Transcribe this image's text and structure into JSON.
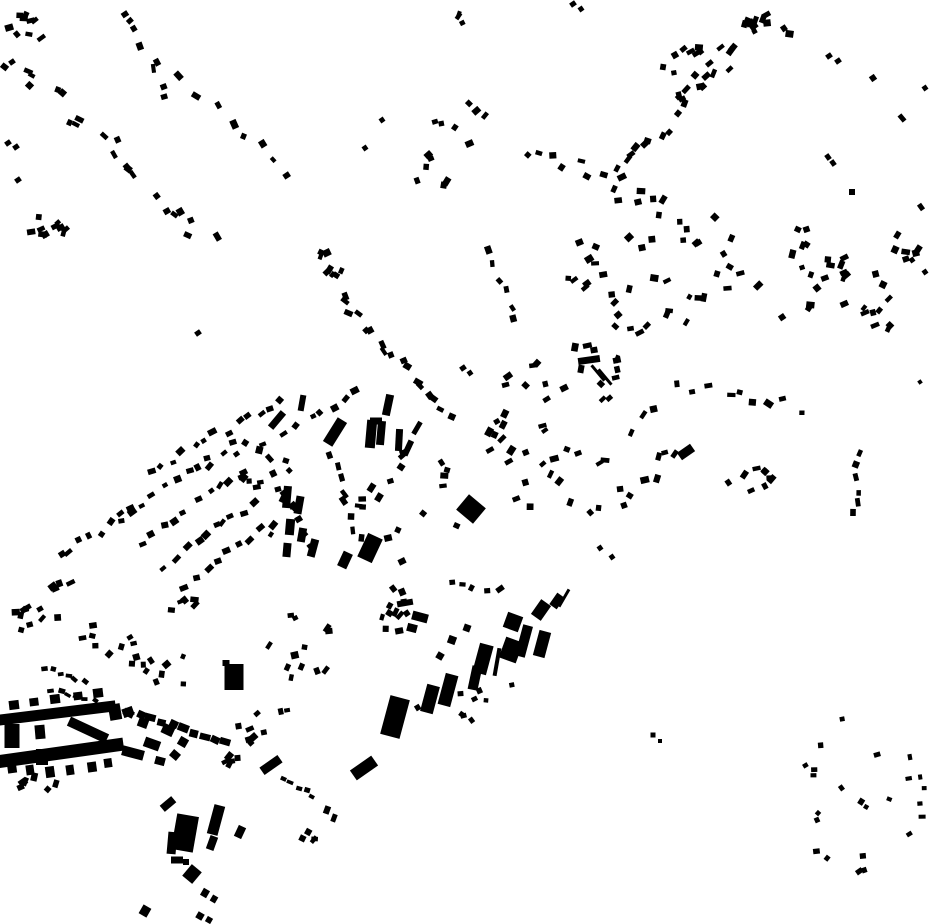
{
  "meta": {
    "title": "building-footprint-map",
    "width": 930,
    "height": 924,
    "background_color": "#ffffff",
    "building_color": "#000000"
  },
  "buildings": [
    [
      57,
      713,
      118,
      11,
      -7
    ],
    [
      60,
      753,
      128,
      13,
      -8
    ],
    [
      14,
      705,
      10,
      9,
      -7
    ],
    [
      34,
      702,
      9,
      8,
      -7
    ],
    [
      55,
      699,
      10,
      9,
      -7
    ],
    [
      78,
      696,
      9,
      8,
      -7
    ],
    [
      98,
      693,
      10,
      9,
      -7
    ],
    [
      12,
      736,
      15,
      24,
      0
    ],
    [
      40,
      732,
      10,
      14,
      -5
    ],
    [
      42,
      757,
      12,
      16,
      0
    ],
    [
      115,
      712,
      12,
      16,
      -10
    ],
    [
      88,
      730,
      42,
      10,
      25
    ],
    [
      12,
      768,
      9,
      10,
      -8
    ],
    [
      30,
      770,
      8,
      10,
      -8
    ],
    [
      50,
      772,
      9,
      11,
      -8
    ],
    [
      70,
      770,
      8,
      10,
      -8
    ],
    [
      92,
      767,
      9,
      10,
      -8
    ],
    [
      108,
      763,
      8,
      9,
      -8
    ],
    [
      133,
      753,
      22,
      10,
      15
    ],
    [
      152,
      744,
      16,
      10,
      20
    ],
    [
      168,
      730,
      12,
      10,
      25
    ],
    [
      143,
      723,
      10,
      9,
      20
    ],
    [
      128,
      712,
      11,
      9,
      -20
    ],
    [
      160,
      761,
      10,
      8,
      15
    ],
    [
      175,
      755,
      9,
      8,
      40
    ],
    [
      183,
      742,
      9,
      9,
      30
    ],
    [
      234,
      677,
      19,
      26,
      0
    ],
    [
      226,
      663,
      7,
      6,
      0
    ],
    [
      395,
      717,
      20,
      40,
      15
    ],
    [
      430,
      699,
      13,
      28,
      15
    ],
    [
      448,
      690,
      13,
      32,
      15
    ],
    [
      475,
      678,
      10,
      24,
      12
    ],
    [
      483,
      659,
      14,
      30,
      15
    ],
    [
      497,
      662,
      4,
      28,
      10
    ],
    [
      513,
      622,
      16,
      16,
      20
    ],
    [
      511,
      650,
      18,
      22,
      20
    ],
    [
      524,
      641,
      10,
      32,
      15
    ],
    [
      542,
      644,
      12,
      26,
      15
    ],
    [
      541,
      610,
      12,
      18,
      35
    ],
    [
      557,
      601,
      9,
      14,
      35
    ],
    [
      564,
      598,
      3,
      20,
      30
    ],
    [
      452,
      640,
      8,
      8,
      20
    ],
    [
      467,
      628,
      7,
      7,
      20
    ],
    [
      440,
      656,
      7,
      7,
      30
    ],
    [
      405,
      603,
      16,
      6,
      -10
    ],
    [
      420,
      617,
      16,
      9,
      15
    ],
    [
      412,
      628,
      10,
      8,
      15
    ],
    [
      185,
      833,
      22,
      36,
      10
    ],
    [
      172,
      843,
      9,
      22,
      5
    ],
    [
      177,
      860,
      12,
      7,
      0
    ],
    [
      168,
      804,
      15,
      8,
      -40
    ],
    [
      216,
      820,
      11,
      30,
      15
    ],
    [
      212,
      843,
      8,
      14,
      20
    ],
    [
      240,
      832,
      8,
      12,
      25
    ],
    [
      192,
      874,
      13,
      15,
      40
    ],
    [
      145,
      911,
      9,
      10,
      30
    ],
    [
      205,
      893,
      7,
      8,
      30
    ],
    [
      214,
      899,
      6,
      7,
      30
    ],
    [
      200,
      916,
      7,
      7,
      30
    ],
    [
      209,
      920,
      6,
      6,
      30
    ],
    [
      186,
      862,
      6,
      6,
      0
    ],
    [
      364,
      768,
      26,
      12,
      -35
    ],
    [
      271,
      765,
      22,
      9,
      -35
    ],
    [
      327,
      810,
      6,
      8,
      20
    ],
    [
      334,
      818,
      5,
      8,
      20
    ],
    [
      589,
      360,
      22,
      7,
      -8
    ],
    [
      594,
      350,
      7,
      6,
      -10
    ],
    [
      598,
      373,
      3,
      20,
      -40
    ],
    [
      605,
      377,
      3,
      20,
      -40
    ],
    [
      581,
      369,
      6,
      8,
      10
    ],
    [
      471,
      509,
      22,
      20,
      40
    ],
    [
      686,
      452,
      16,
      9,
      -35
    ],
    [
      388,
      405,
      8,
      21,
      12
    ],
    [
      335,
      432,
      11,
      28,
      32
    ],
    [
      371,
      434,
      10,
      28,
      5
    ],
    [
      381,
      433,
      8,
      24,
      5
    ],
    [
      376,
      421,
      12,
      7,
      0
    ],
    [
      399,
      440,
      7,
      22,
      3
    ],
    [
      408,
      448,
      6,
      16,
      25
    ],
    [
      417,
      428,
      5,
      14,
      30
    ],
    [
      277,
      420,
      7,
      20,
      40
    ],
    [
      302,
      403,
      6,
      16,
      10
    ],
    [
      287,
      497,
      8,
      22,
      5
    ],
    [
      299,
      505,
      8,
      18,
      10
    ],
    [
      290,
      527,
      9,
      16,
      5
    ],
    [
      302,
      535,
      8,
      14,
      10
    ],
    [
      287,
      550,
      8,
      14,
      5
    ],
    [
      313,
      548,
      8,
      18,
      15
    ],
    [
      370,
      548,
      16,
      26,
      25
    ],
    [
      345,
      560,
      10,
      16,
      25
    ],
    [
      653,
      735,
      5,
      5,
      0
    ],
    [
      660,
      741,
      4,
      4,
      0
    ],
    [
      12,
      62,
      6,
      5,
      -35
    ],
    [
      8,
      143,
      6,
      5,
      -35
    ],
    [
      16,
      147,
      6,
      5,
      -35
    ],
    [
      18,
      180,
      6,
      5,
      -35
    ],
    [
      198,
      333,
      6,
      5,
      -35
    ],
    [
      463,
      368,
      6,
      5,
      -35
    ],
    [
      470,
      373,
      5,
      5,
      -35
    ],
    [
      573,
      4,
      6,
      5,
      -35
    ],
    [
      581,
      9,
      5,
      5,
      -35
    ],
    [
      829,
      56,
      6,
      5,
      -35
    ],
    [
      838,
      61,
      6,
      5,
      -35
    ],
    [
      873,
      78,
      6,
      6,
      -35
    ],
    [
      902,
      118,
      5,
      8,
      -40
    ],
    [
      925,
      88,
      5,
      5,
      -35
    ],
    [
      828,
      157,
      5,
      6,
      -35
    ],
    [
      833,
      163,
      5,
      6,
      -35
    ],
    [
      852,
      192,
      6,
      6,
      0
    ],
    [
      921,
      207,
      5,
      7,
      -35
    ],
    [
      912,
      260,
      5,
      5,
      -35
    ],
    [
      925,
      272,
      5,
      5,
      -35
    ],
    [
      920,
      382,
      4,
      4,
      -35
    ],
    [
      600,
      548,
      5,
      5,
      -35
    ],
    [
      612,
      557,
      5,
      5,
      -35
    ],
    [
      28,
      607,
      6,
      5,
      -30
    ],
    [
      40,
      609,
      6,
      5,
      -30
    ],
    [
      382,
      120,
      5,
      5,
      -35
    ],
    [
      365,
      148,
      5,
      5,
      -35
    ]
  ],
  "clusters": [
    {
      "type": "chain",
      "seed": 101,
      "count": 22,
      "from": [
        14,
        60
      ],
      "to": [
        208,
        247
      ],
      "jitter": 13
    },
    {
      "type": "blob",
      "seed": 102,
      "count": 9,
      "center": [
        30,
        30
      ],
      "radius": [
        22,
        18
      ]
    },
    {
      "type": "chain",
      "seed": 103,
      "count": 8,
      "from": [
        128,
        8
      ],
      "to": [
        170,
        100
      ],
      "jitter": 7
    },
    {
      "type": "blob",
      "seed": 104,
      "count": 10,
      "center": [
        42,
        230
      ],
      "radius": [
        24,
        13
      ]
    },
    {
      "type": "chain",
      "seed": 105,
      "count": 8,
      "from": [
        183,
        78
      ],
      "to": [
        290,
        175
      ],
      "jitter": 6
    },
    {
      "type": "blob",
      "seed": 106,
      "count": 8,
      "center": [
        333,
        262
      ],
      "radius": [
        15,
        17
      ]
    },
    {
      "type": "chain",
      "seed": 107,
      "count": 17,
      "from": [
        340,
        298
      ],
      "to": [
        452,
        412
      ],
      "jitter": 6
    },
    {
      "type": "chain",
      "seed": 108,
      "count": 6,
      "from": [
        489,
        251
      ],
      "to": [
        514,
        318
      ],
      "jitter": 4
    },
    {
      "type": "blob",
      "seed": 109,
      "count": 7,
      "center": [
        462,
        124
      ],
      "radius": [
        28,
        22
      ]
    },
    {
      "type": "blob",
      "seed": 110,
      "count": 6,
      "center": [
        432,
        170
      ],
      "radius": [
        24,
        18
      ]
    },
    {
      "type": "chain",
      "seed": 111,
      "count": 7,
      "from": [
        520,
        150
      ],
      "to": [
        608,
        177
      ],
      "jitter": 8
    },
    {
      "type": "chain",
      "seed": 112,
      "count": 26,
      "from": [
        612,
        186
      ],
      "to": [
        764,
        12
      ],
      "jitter": 9
    },
    {
      "type": "blob",
      "seed": 113,
      "count": 12,
      "center": [
        688,
        72
      ],
      "radius": [
        26,
        28
      ]
    },
    {
      "type": "blob",
      "seed": 114,
      "count": 7,
      "center": [
        772,
        22
      ],
      "radius": [
        28,
        16
      ]
    },
    {
      "type": "blob",
      "seed": 115,
      "count": 46,
      "center": [
        650,
        262
      ],
      "radius": [
        92,
        72
      ]
    },
    {
      "type": "blob",
      "seed": 116,
      "count": 15,
      "center": [
        790,
        272
      ],
      "radius": [
        42,
        50
      ]
    },
    {
      "type": "blob",
      "seed": 117,
      "count": 22,
      "center": [
        882,
        282
      ],
      "radius": [
        46,
        52
      ]
    },
    {
      "type": "chain",
      "seed": 118,
      "count": 9,
      "from": [
        683,
        386
      ],
      "to": [
        795,
        408
      ],
      "jitter": 7
    },
    {
      "type": "blob",
      "seed": 119,
      "count": 9,
      "center": [
        752,
        482
      ],
      "radius": [
        27,
        15
      ]
    },
    {
      "type": "chain",
      "seed": 120,
      "count": 6,
      "from": [
        856,
        457
      ],
      "to": [
        855,
        512
      ],
      "jitter": 4
    },
    {
      "type": "blob",
      "seed": 121,
      "count": 54,
      "center": [
        575,
        432
      ],
      "radius": [
        105,
        92
      ]
    },
    {
      "type": "chain",
      "seed": 122,
      "count": 13,
      "from": [
        150,
        472
      ],
      "to": [
        280,
        399
      ],
      "jitter": 4
    },
    {
      "type": "chain",
      "seed": 123,
      "count": 11,
      "from": [
        118,
        516
      ],
      "to": [
        232,
        446
      ],
      "jitter": 4
    },
    {
      "type": "chain",
      "seed": 124,
      "count": 8,
      "from": [
        60,
        556
      ],
      "to": [
        128,
        512
      ],
      "jitter": 4
    },
    {
      "type": "chain",
      "seed": 125,
      "count": 10,
      "from": [
        140,
        541
      ],
      "to": [
        242,
        471
      ],
      "jitter": 4
    },
    {
      "type": "chain",
      "seed": 126,
      "count": 9,
      "from": [
        163,
        566
      ],
      "to": [
        256,
        502
      ],
      "jitter": 4
    },
    {
      "type": "chain",
      "seed": 127,
      "count": 9,
      "from": [
        186,
        584
      ],
      "to": [
        272,
        522
      ],
      "jitter": 4
    },
    {
      "type": "chain",
      "seed": 128,
      "count": 8,
      "from": [
        270,
        462
      ],
      "to": [
        308,
        546
      ],
      "jitter": 4
    },
    {
      "type": "chain",
      "seed": 129,
      "count": 8,
      "from": [
        332,
        457
      ],
      "to": [
        358,
        540
      ],
      "jitter": 4
    },
    {
      "type": "chain",
      "seed": 130,
      "count": 7,
      "from": [
        286,
        430
      ],
      "to": [
        356,
        392
      ],
      "jitter": 4
    },
    {
      "type": "blob",
      "seed": 131,
      "count": 16,
      "center": [
        250,
        490
      ],
      "radius": [
        60,
        48
      ]
    },
    {
      "type": "blob",
      "seed": 132,
      "count": 18,
      "center": [
        410,
        505
      ],
      "radius": [
        55,
        60
      ]
    },
    {
      "type": "blob",
      "seed": 133,
      "count": 9,
      "center": [
        38,
        620
      ],
      "radius": [
        26,
        18
      ]
    },
    {
      "type": "chain",
      "seed": 134,
      "count": 6,
      "from": [
        44,
        668
      ],
      "to": [
        84,
        680
      ],
      "jitter": 2,
      "w": [
        5,
        7
      ],
      "h": [
        3,
        5
      ]
    },
    {
      "type": "chain",
      "seed": 135,
      "count": 6,
      "from": [
        52,
        690
      ],
      "to": [
        94,
        702
      ],
      "jitter": 2,
      "w": [
        5,
        7
      ],
      "h": [
        3,
        5
      ]
    },
    {
      "type": "blob",
      "seed": 136,
      "count": 5,
      "center": [
        182,
        605
      ],
      "radius": [
        18,
        8
      ]
    },
    {
      "type": "blob",
      "seed": 137,
      "count": 12,
      "center": [
        298,
        640
      ],
      "radius": [
        52,
        38
      ]
    },
    {
      "type": "chain",
      "seed": 138,
      "count": 10,
      "from": [
        130,
        712
      ],
      "to": [
        226,
        743
      ],
      "jitter": 2,
      "w": [
        8,
        11
      ],
      "h": [
        6,
        8
      ],
      "rotJitter": 10
    },
    {
      "type": "blob",
      "seed": 139,
      "count": 9,
      "center": [
        268,
        726
      ],
      "radius": [
        36,
        20
      ]
    },
    {
      "type": "blob",
      "seed": 140,
      "count": 10,
      "center": [
        468,
        706
      ],
      "radius": [
        55,
        35
      ],
      "w": [
        4,
        7
      ],
      "h": [
        4,
        6
      ]
    },
    {
      "type": "blob",
      "seed": 141,
      "count": 11,
      "center": [
        400,
        612
      ],
      "radius": [
        38,
        26
      ]
    },
    {
      "type": "blob",
      "seed": 142,
      "count": 24,
      "center": [
        853,
        795
      ],
      "radius": [
        72,
        78
      ],
      "w": [
        4,
        7
      ],
      "h": [
        4,
        6
      ]
    },
    {
      "type": "chain",
      "seed": 143,
      "count": 5,
      "from": [
        282,
        779
      ],
      "to": [
        313,
        796
      ],
      "jitter": 2,
      "w": [
        5,
        7
      ],
      "h": [
        3,
        5
      ]
    },
    {
      "type": "blob",
      "seed": 144,
      "count": 4,
      "center": [
        306,
        837
      ],
      "radius": [
        13,
        7
      ]
    },
    {
      "type": "blob",
      "seed": 145,
      "count": 6,
      "center": [
        40,
        788
      ],
      "radius": [
        28,
        12
      ]
    },
    {
      "type": "blob",
      "seed": 146,
      "count": 10,
      "center": [
        150,
        672
      ],
      "radius": [
        40,
        28
      ]
    },
    {
      "type": "blob",
      "seed": 147,
      "count": 8,
      "center": [
        105,
        640
      ],
      "radius": [
        30,
        20
      ]
    },
    {
      "type": "blob",
      "seed": 148,
      "count": 3,
      "center": [
        468,
        16
      ],
      "radius": [
        10,
        10
      ]
    },
    {
      "type": "blob",
      "seed": 149,
      "count": 4,
      "center": [
        62,
        585
      ],
      "radius": [
        14,
        10
      ]
    },
    {
      "type": "blob",
      "seed": 150,
      "count": 5,
      "center": [
        232,
        762
      ],
      "radius": [
        18,
        10
      ]
    },
    {
      "type": "blob",
      "seed": 151,
      "count": 5,
      "center": [
        490,
        585
      ],
      "radius": [
        40,
        15
      ]
    }
  ],
  "cluster_defaults": {
    "w": [
      5,
      9
    ],
    "h": [
      4,
      7
    ],
    "blob_rot": -35,
    "blob_rot_jitter": 45,
    "chain_rot": "auto",
    "chain_rot_jitter": 25
  }
}
